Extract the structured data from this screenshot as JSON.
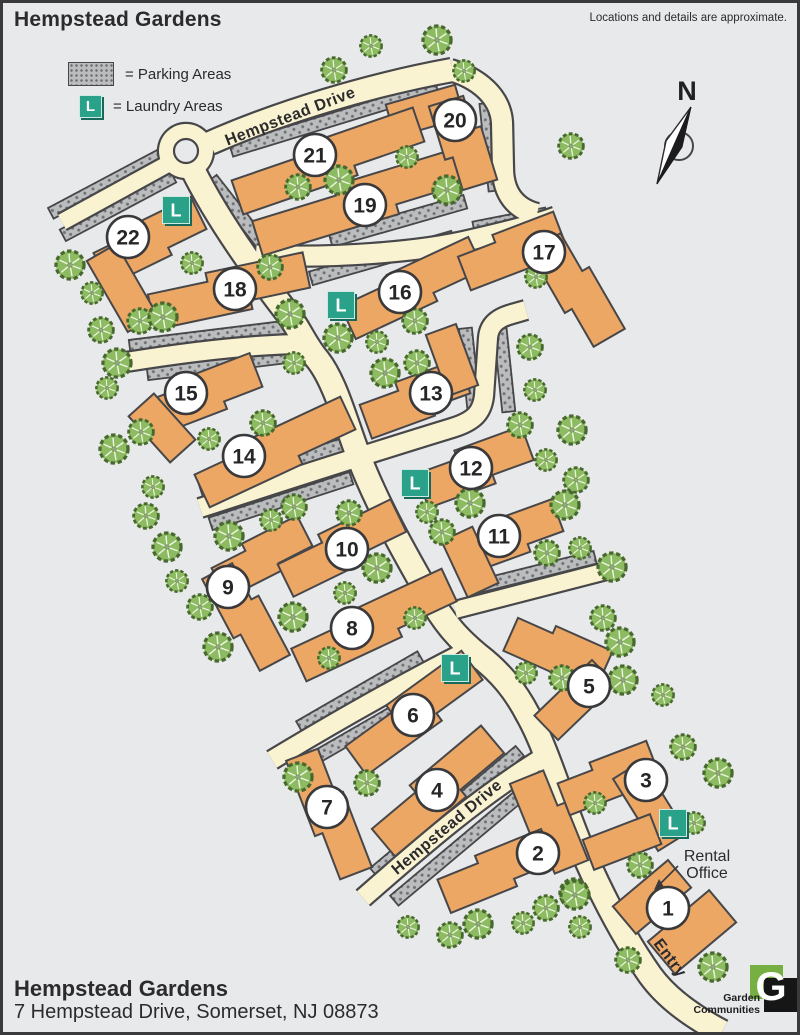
{
  "header": {
    "title": "Hempstead Gardens",
    "disclaimer": "Locations and details are approximate."
  },
  "legend": {
    "parking_label": "= Parking Areas",
    "laundry_label": "= Laundry Areas",
    "laundry_letter": "L"
  },
  "compass": {
    "label": "N"
  },
  "footer": {
    "name": "Hempstead Gardens",
    "address": "7 Hempstead Drive, Somerset, NJ 08873"
  },
  "logo": {
    "letter": "G",
    "line1": "Garden",
    "line2": "Communities"
  },
  "rental_office": {
    "line1": "Rental",
    "line2": "Office"
  },
  "map": {
    "colors": {
      "road": "#faf3d2",
      "road_edge": "#47474a",
      "building": "#eca765",
      "building_edge": "#47474a",
      "parking_bg": "#babcbe",
      "parking_dot": "#6f7174",
      "tree_fill": "#8dbb61",
      "tree_edge": "#47682e",
      "tree_vein": "#eef5e4",
      "laundry": "#2aa189",
      "laundry_dark": "#17695a",
      "circle_fill": "#ffffff",
      "text": "#2b2b2d",
      "bg": "#e8e9ea"
    },
    "street_labels": [
      {
        "text": "Hempstead Drive",
        "x": 292,
        "y": 121,
        "angle": -21
      },
      {
        "text": "Hempstead Drive",
        "x": 450,
        "y": 831,
        "angle": -40
      },
      {
        "text": "Entry",
        "x": 666,
        "y": 961,
        "angle": 53
      }
    ],
    "roundabout": {
      "x": 186,
      "y": 151,
      "r_outer": 27,
      "r_inner": 12
    },
    "roads": [
      {
        "name": "hempstead-drive-top",
        "d": "M 210,143 C 280,112 370,85 452,70",
        "w": 22
      },
      {
        "name": "north-spur",
        "d": "M 450,70 C 478,78 500,96 502,122 L 503,168 C 503,194 516,209 537,214",
        "w": 20
      },
      {
        "name": "upper-cross-road",
        "d": "M 256,255 C 330,259 420,252 470,240 C 505,232 537,224 556,217",
        "w": 19
      },
      {
        "name": "west-court",
        "d": "M 166,165 L 62,222",
        "w": 16
      },
      {
        "name": "main-spine",
        "d": "M 192,168 C 215,215 250,265 288,314 C 300,330 305,345 318,360 C 335,382 345,420 357,452 C 375,500 400,545 428,594 C 445,625 460,640 478,655 C 500,672 515,690 528,715 C 545,745 558,790 578,840 C 598,888 622,935 650,975 C 668,1000 695,1018 722,1032",
        "w": 23
      },
      {
        "name": "west-branch",
        "d": "M 126,362 C 200,350 260,344 308,344",
        "w": 18
      },
      {
        "name": "mid-cross-road",
        "d": "M 200,508 C 280,482 380,450 452,428 C 475,421 482,412 484,396 L 488,338 C 489,325 497,318 512,314 L 526,310",
        "w": 18
      },
      {
        "name": "east-spur",
        "d": "M 455,610 L 618,568",
        "w": 16
      },
      {
        "name": "south-west-branch",
        "d": "M 272,760 C 330,725 400,685 465,652",
        "w": 18
      },
      {
        "name": "hempstead-drive-lower",
        "d": "M 363,898 C 420,848 480,795 552,752",
        "w": 18
      }
    ],
    "parking": [
      {
        "x": 334,
        "y": 119,
        "angle": -17,
        "len": 215,
        "w": 13
      },
      {
        "x": 106,
        "y": 184,
        "angle": -28,
        "len": 125,
        "w": 12
      },
      {
        "x": 118,
        "y": 206,
        "angle": -28,
        "len": 125,
        "w": 13
      },
      {
        "x": 246,
        "y": 223,
        "angle": 52,
        "len": 112,
        "w": 13
      },
      {
        "x": 398,
        "y": 221,
        "angle": -16,
        "len": 140,
        "w": 14
      },
      {
        "x": 382,
        "y": 258,
        "angle": -16,
        "len": 148,
        "w": 14
      },
      {
        "x": 510,
        "y": 221,
        "angle": -11,
        "len": 74,
        "w": 13
      },
      {
        "x": 491,
        "y": 147,
        "angle": 84,
        "len": 88,
        "w": 14
      },
      {
        "x": 214,
        "y": 336,
        "angle": -7,
        "len": 170,
        "w": 13
      },
      {
        "x": 222,
        "y": 365,
        "angle": -7,
        "len": 150,
        "w": 12
      },
      {
        "x": 277,
        "y": 466,
        "angle": -18,
        "len": 160,
        "w": 13
      },
      {
        "x": 281,
        "y": 501,
        "angle": -18,
        "len": 148,
        "w": 13
      },
      {
        "x": 470,
        "y": 372,
        "angle": 84,
        "len": 88,
        "w": 13
      },
      {
        "x": 504,
        "y": 366,
        "angle": 84,
        "len": 92,
        "w": 13
      },
      {
        "x": 532,
        "y": 573,
        "angle": -14,
        "len": 130,
        "w": 13
      },
      {
        "x": 360,
        "y": 692,
        "angle": -30,
        "len": 140,
        "w": 13
      },
      {
        "x": 377,
        "y": 722,
        "angle": -30,
        "len": 148,
        "w": 13
      },
      {
        "x": 447,
        "y": 812,
        "angle": -40,
        "len": 190,
        "w": 13
      },
      {
        "x": 469,
        "y": 838,
        "angle": -40,
        "len": 195,
        "w": 13
      }
    ],
    "buildings": [
      {
        "n": "1",
        "cx": 668,
        "cy": 908,
        "arms": [
          {
            "x": 652,
            "y": 897,
            "a": -40,
            "len": 72,
            "w": 36,
            "s": 0
          },
          {
            "x": 692,
            "y": 932,
            "a": -40,
            "len": 80,
            "w": 42,
            "s": 0
          }
        ]
      },
      {
        "n": "2",
        "cx": 538,
        "cy": 853,
        "arms": [
          {
            "x": 549,
            "y": 822,
            "a": 68,
            "len": 100,
            "w": 36,
            "s": 8
          },
          {
            "x": 496,
            "y": 871,
            "a": -22,
            "len": 115,
            "w": 36,
            "s": 8
          }
        ]
      },
      {
        "n": "3",
        "cx": 646,
        "cy": 780,
        "arms": [
          {
            "x": 608,
            "y": 778,
            "a": -21,
            "len": 98,
            "w": 34,
            "s": 8
          },
          {
            "x": 650,
            "y": 806,
            "a": 58,
            "len": 85,
            "w": 34,
            "s": 0
          },
          {
            "x": 622,
            "y": 842,
            "a": -21,
            "len": 72,
            "w": 32,
            "s": 0
          }
        ]
      },
      {
        "n": "4",
        "cx": 437,
        "cy": 790,
        "arms": [
          {
            "x": 438,
            "y": 791,
            "a": -40,
            "len": 150,
            "w": 36,
            "s": 9
          }
        ]
      },
      {
        "n": "5",
        "cx": 589,
        "cy": 686,
        "arms": [
          {
            "x": 558,
            "y": 651,
            "a": 24,
            "len": 100,
            "w": 36,
            "s": 8
          },
          {
            "x": 575,
            "y": 700,
            "a": -44,
            "len": 80,
            "w": 34,
            "s": 0
          }
        ]
      },
      {
        "n": "6",
        "cx": 413,
        "cy": 715,
        "arms": [
          {
            "x": 414,
            "y": 713,
            "a": -36,
            "len": 150,
            "w": 36,
            "s": 9
          }
        ]
      },
      {
        "n": "7",
        "cx": 327,
        "cy": 807,
        "arms": [
          {
            "x": 329,
            "y": 814,
            "a": 69,
            "len": 130,
            "w": 34,
            "s": 8
          }
        ]
      },
      {
        "n": "8",
        "cx": 352,
        "cy": 628,
        "arms": [
          {
            "x": 374,
            "y": 625,
            "a": -25,
            "len": 170,
            "w": 36,
            "s": 9
          }
        ]
      },
      {
        "n": "9",
        "cx": 228,
        "cy": 587,
        "arms": [
          {
            "x": 262,
            "y": 557,
            "a": -27,
            "len": 100,
            "w": 34,
            "s": 8
          },
          {
            "x": 246,
            "y": 617,
            "a": 62,
            "len": 108,
            "w": 34,
            "s": 8
          }
        ]
      },
      {
        "n": "10",
        "cx": 347,
        "cy": 549,
        "arms": [
          {
            "x": 342,
            "y": 548,
            "a": -26,
            "len": 130,
            "w": 36,
            "s": 9
          }
        ]
      },
      {
        "n": "11",
        "cx": 499,
        "cy": 536,
        "arms": [
          {
            "x": 512,
            "y": 536,
            "a": -20,
            "len": 100,
            "w": 34,
            "s": 8
          },
          {
            "x": 470,
            "y": 562,
            "a": 65,
            "len": 62,
            "w": 34,
            "s": 0
          }
        ]
      },
      {
        "n": "12",
        "cx": 471,
        "cy": 468,
        "arms": [
          {
            "x": 475,
            "y": 467,
            "a": -20,
            "len": 115,
            "w": 36,
            "s": 9
          }
        ]
      },
      {
        "n": "13",
        "cx": 431,
        "cy": 393,
        "arms": [
          {
            "x": 415,
            "y": 399,
            "a": -20,
            "len": 108,
            "w": 36,
            "s": 9
          },
          {
            "x": 452,
            "y": 360,
            "a": 70,
            "len": 65,
            "w": 32,
            "s": 0
          }
        ]
      },
      {
        "n": "14",
        "cx": 244,
        "cy": 456,
        "arms": [
          {
            "x": 275,
            "y": 452,
            "a": -25,
            "len": 165,
            "w": 36,
            "s": 9
          }
        ]
      },
      {
        "n": "15",
        "cx": 186,
        "cy": 393,
        "arms": [
          {
            "x": 207,
            "y": 393,
            "a": -21,
            "len": 108,
            "w": 36,
            "s": 8
          },
          {
            "x": 162,
            "y": 428,
            "a": 48,
            "len": 62,
            "w": 34,
            "s": 0
          }
        ]
      },
      {
        "n": "16",
        "cx": 400,
        "cy": 292,
        "arms": [
          {
            "x": 412,
            "y": 288,
            "a": -25,
            "len": 145,
            "w": 36,
            "s": 9
          }
        ]
      },
      {
        "n": "17",
        "cx": 544,
        "cy": 252,
        "arms": [
          {
            "x": 512,
            "y": 251,
            "a": -21,
            "len": 105,
            "w": 36,
            "s": 8
          },
          {
            "x": 577,
            "y": 290,
            "a": 60,
            "len": 115,
            "w": 36,
            "s": 8
          }
        ]
      },
      {
        "n": "18",
        "cx": 235,
        "cy": 289,
        "arms": [
          {
            "x": 229,
            "y": 291,
            "a": -12,
            "len": 160,
            "w": 36,
            "s": 9
          }
        ]
      },
      {
        "n": "19",
        "cx": 365,
        "cy": 205,
        "arms": [
          {
            "x": 366,
            "y": 200,
            "a": -17,
            "len": 230,
            "w": 36,
            "s": 10
          }
        ]
      },
      {
        "n": "20",
        "cx": 455,
        "cy": 120,
        "arms": [
          {
            "x": 425,
            "y": 111,
            "a": -16,
            "len": 72,
            "w": 34,
            "s": 0
          },
          {
            "x": 463,
            "y": 143,
            "a": 73,
            "len": 90,
            "w": 36,
            "s": 8
          }
        ]
      },
      {
        "n": "21",
        "cx": 315,
        "cy": 155,
        "arms": [
          {
            "x": 328,
            "y": 161,
            "a": -19,
            "len": 195,
            "w": 36,
            "s": 10
          }
        ]
      },
      {
        "n": "22",
        "cx": 128,
        "cy": 237,
        "arms": [
          {
            "x": 150,
            "y": 241,
            "a": -26,
            "len": 112,
            "w": 36,
            "s": 8
          },
          {
            "x": 122,
            "y": 288,
            "a": 60,
            "len": 82,
            "w": 34,
            "s": 0
          }
        ]
      }
    ],
    "laundries": [
      {
        "x": 176,
        "y": 210
      },
      {
        "x": 341,
        "y": 305
      },
      {
        "x": 415,
        "y": 483
      },
      {
        "x": 455,
        "y": 668
      },
      {
        "x": 673,
        "y": 823
      }
    ],
    "trees": [
      [
        371,
        46
      ],
      [
        334,
        70
      ],
      [
        437,
        40
      ],
      [
        464,
        71
      ],
      [
        571,
        146
      ],
      [
        447,
        190
      ],
      [
        407,
        157
      ],
      [
        298,
        187
      ],
      [
        339,
        180
      ],
      [
        536,
        277
      ],
      [
        530,
        347
      ],
      [
        70,
        265
      ],
      [
        92,
        293
      ],
      [
        101,
        330
      ],
      [
        117,
        363
      ],
      [
        107,
        388
      ],
      [
        140,
        321
      ],
      [
        163,
        317
      ],
      [
        192,
        263
      ],
      [
        270,
        267
      ],
      [
        290,
        314
      ],
      [
        294,
        363
      ],
      [
        141,
        432
      ],
      [
        114,
        449
      ],
      [
        153,
        487
      ],
      [
        146,
        516
      ],
      [
        167,
        547
      ],
      [
        177,
        581
      ],
      [
        200,
        607
      ],
      [
        218,
        647
      ],
      [
        209,
        439
      ],
      [
        263,
        423
      ],
      [
        229,
        536
      ],
      [
        271,
        520
      ],
      [
        294,
        507
      ],
      [
        293,
        617
      ],
      [
        329,
        658
      ],
      [
        349,
        513
      ],
      [
        377,
        568
      ],
      [
        345,
        593
      ],
      [
        415,
        321
      ],
      [
        338,
        338
      ],
      [
        377,
        342
      ],
      [
        417,
        363
      ],
      [
        385,
        373
      ],
      [
        535,
        390
      ],
      [
        520,
        425
      ],
      [
        572,
        430
      ],
      [
        546,
        460
      ],
      [
        576,
        480
      ],
      [
        470,
        503
      ],
      [
        427,
        512
      ],
      [
        442,
        532
      ],
      [
        565,
        505
      ],
      [
        580,
        548
      ],
      [
        547,
        553
      ],
      [
        612,
        567
      ],
      [
        415,
        618
      ],
      [
        367,
        783
      ],
      [
        298,
        777
      ],
      [
        408,
        927
      ],
      [
        450,
        935
      ],
      [
        478,
        924
      ],
      [
        523,
        923
      ],
      [
        546,
        908
      ],
      [
        574,
        893
      ],
      [
        595,
        803
      ],
      [
        603,
        618
      ],
      [
        620,
        642
      ],
      [
        526,
        673
      ],
      [
        562,
        678
      ],
      [
        623,
        680
      ],
      [
        663,
        695
      ],
      [
        683,
        747
      ],
      [
        718,
        773
      ],
      [
        694,
        823
      ],
      [
        640,
        865
      ],
      [
        575,
        895
      ],
      [
        580,
        927
      ],
      [
        628,
        960
      ],
      [
        713,
        967
      ]
    ]
  }
}
